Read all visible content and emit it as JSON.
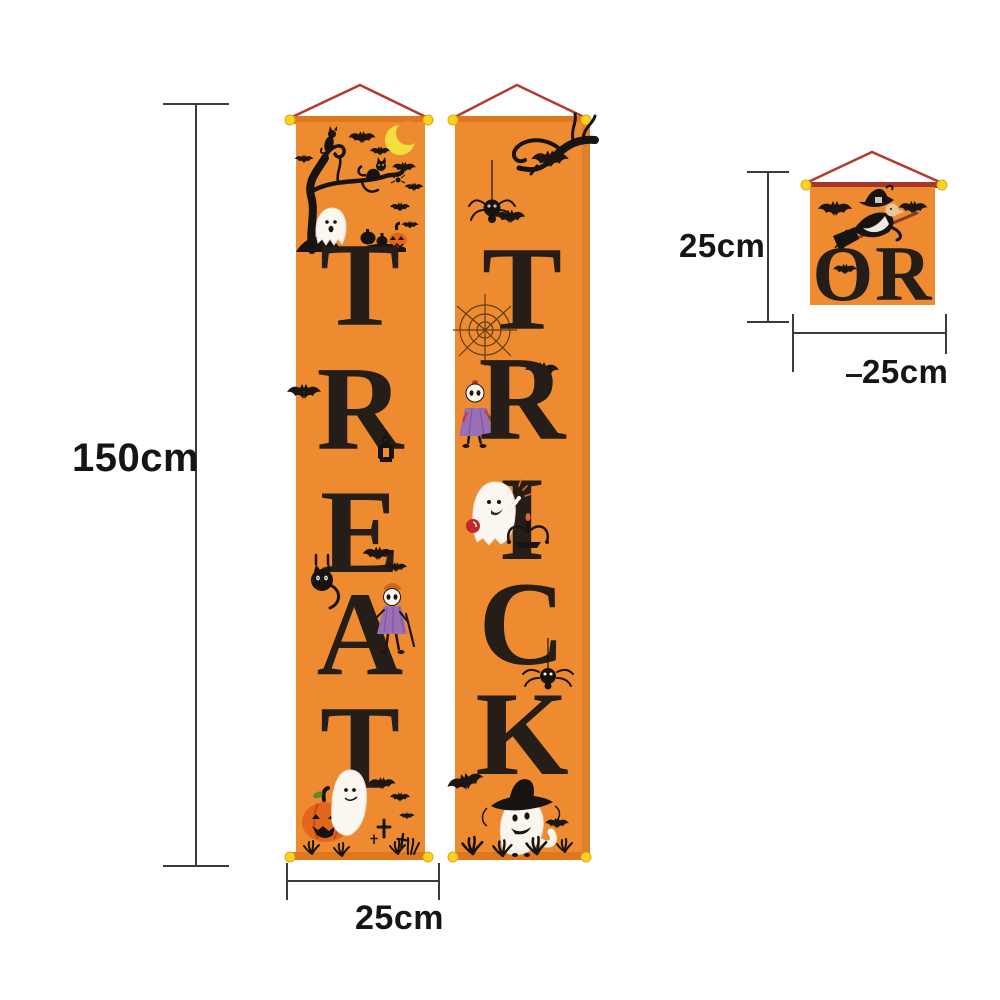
{
  "page": {
    "description": "Halloween Trick or Treat hanging porch banner size chart on white background"
  },
  "dimensions": {
    "tall_banner_height_label": "150cm",
    "tall_banner_width_label": "25cm",
    "small_banner_height_label": "25cm",
    "small_banner_width_label": "25cm"
  },
  "banners": {
    "treat": {
      "word": "TREAT",
      "letters": [
        "T",
        "R",
        "E",
        "A",
        "T"
      ]
    },
    "trick": {
      "word": "TRICK",
      "letters": [
        "T",
        "R",
        "I",
        "C",
        "K"
      ]
    },
    "or": {
      "word": "OR"
    }
  },
  "colors": {
    "banner_orange": "#EE8B30",
    "rod_orange": "#DF771E",
    "small_rod_red": "#A8352C",
    "letter_black": "#241D18",
    "art_black": "#171310",
    "string_red": "#B23B30",
    "knob_yellow": "#FFD21E",
    "knob_edge": "#D9A81B",
    "pumpkin_orange": "#E3661C",
    "moon_yellow": "#F2DE3D",
    "ghost_white": "#FBF7F0",
    "skeleton_purple": "#9B6FB5",
    "dimension_line": "#3B3B3B"
  },
  "artwork": {
    "treat_banner": [
      "spooky-tree",
      "black-cats",
      "crescent-moon",
      "bats",
      "ghost",
      "pumpkins",
      "lantern",
      "hanging-cat",
      "skeleton-kid",
      "ghost-on-pumpkin",
      "grave-crosses",
      "grass"
    ],
    "trick_banner": [
      "dead-tree-branch",
      "hanging-spider",
      "bats",
      "spider-web",
      "skeleton-kid",
      "ghost-with-lollipop",
      "pumpkin-candelabra",
      "spider",
      "ghost-with-witch-hat",
      "grass"
    ],
    "or_banner": [
      "witch-on-broom",
      "bats"
    ]
  }
}
